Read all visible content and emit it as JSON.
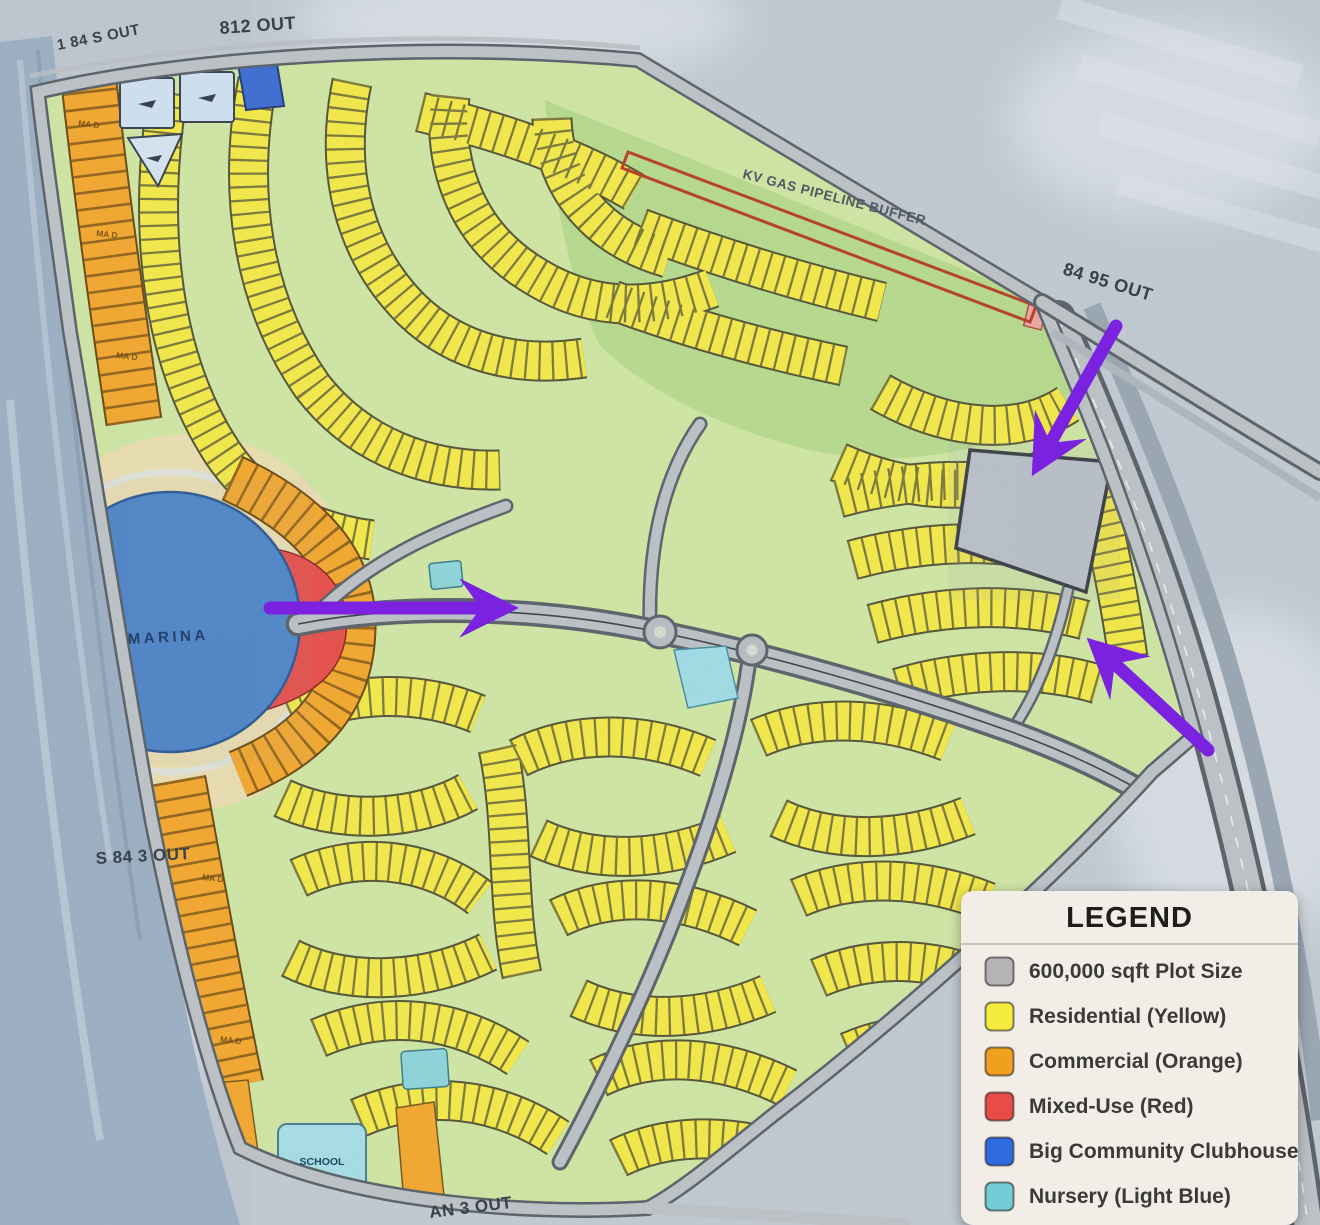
{
  "map": {
    "road_labels": {
      "top_left": "1 84 S OUT",
      "top": "812 OUT",
      "right": "84 95 OUT",
      "left": "S 84 3 OUT",
      "bottom": "AN 3 OUT"
    },
    "pipeline_label": "KV GAS PIPELINE BUFFER",
    "marina_label": "MARINA",
    "school_label": "SCHOOL",
    "commercial_plot_code": "MA D"
  },
  "legend": {
    "title": "LEGEND",
    "items": [
      {
        "label": "600,000 sqft Plot Size",
        "color": "#b4b4b4"
      },
      {
        "label": "Residential (Yellow)",
        "color": "#f5ec3d"
      },
      {
        "label": "Commercial (Orange)",
        "color": "#f0a01f"
      },
      {
        "label": "Mixed-Use (Red)",
        "color": "#e74c47"
      },
      {
        "label": "Big Community Clubhouse",
        "color": "#2e6ce0"
      },
      {
        "label": "Nursery (Light Blue)",
        "color": "#73ccd6"
      }
    ]
  },
  "annotations": {
    "arrow_color": "#7a22e0",
    "arrows": [
      {
        "name": "arrow-to-gray-plot",
        "direction": "down-left"
      },
      {
        "name": "arrow-to-center",
        "direction": "right"
      },
      {
        "name": "arrow-to-east-edge",
        "direction": "up-left"
      }
    ]
  },
  "colors": {
    "residential": "#f2e84b",
    "commercial": "#f2a832",
    "mixed_use": "#e6514c",
    "clubhouse_blue": "#4f86c9",
    "nursery": "#8fd4da",
    "plot_gray": "#bdc3ca",
    "greenspace": "#cfe5a4",
    "field_green": "#b7da8e"
  }
}
